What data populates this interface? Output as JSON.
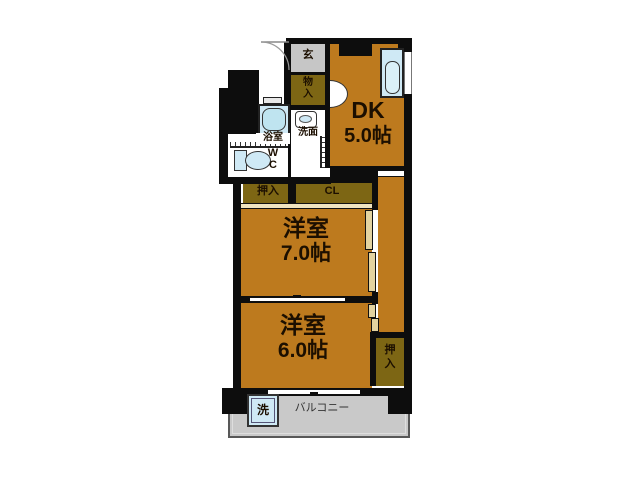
{
  "title": "apartment-floor-plan",
  "palette": {
    "room_fill": "#bd7a1e",
    "closet_fill": "#7d6614",
    "entry_fill": "#c6c6c6",
    "balcony_fill": "#c9c9c9",
    "fixture_fill": "#cfe9f5",
    "wall": "#0d0d0d"
  },
  "rooms": {
    "dk": {
      "line1": "DK",
      "line2": "5.0帖"
    },
    "western7": {
      "line1": "洋室",
      "line2": "7.0帖"
    },
    "western6": {
      "line1": "洋室",
      "line2": "6.0帖"
    }
  },
  "entry": {
    "label": "玄"
  },
  "closets": {
    "monoire": {
      "line1": "物",
      "line2": "入"
    },
    "oshiire_left": {
      "label": "押入"
    },
    "cl": {
      "label": "CL"
    },
    "oshiire_right": {
      "line1": "押",
      "line2": "入"
    }
  },
  "sanitary": {
    "washstand": {
      "label": "洗面"
    },
    "bathroom": {
      "label": "浴室"
    },
    "toilet": {
      "line1": "W",
      "line2": "C"
    }
  },
  "balcony": {
    "label": "バルコニー",
    "washer_label": "洗"
  }
}
